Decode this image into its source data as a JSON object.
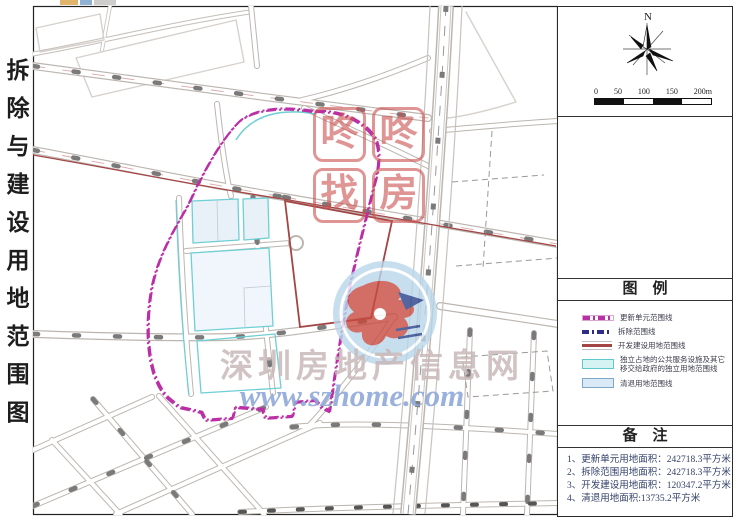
{
  "title": "拆除与建设用地范围图",
  "north": {
    "label": "N"
  },
  "scale": {
    "labels": [
      "0",
      "50",
      "100",
      "150",
      "200m"
    ]
  },
  "legend": {
    "title": "图　例",
    "items": [
      {
        "label": "更新单元范围线",
        "color": "#BB2FA6",
        "style": "dash-dot"
      },
      {
        "label": "拆除范围线",
        "color": "#2E2E88",
        "style": "dashed"
      },
      {
        "label": "开发建设用地范围线",
        "color": "#A34545",
        "style": "solid"
      },
      {
        "label": "独立占地的公共服务设施及其它",
        "label2": "移交给政府的独立用地范围线",
        "color": "#6ECFD4",
        "style": "fill"
      },
      {
        "label": "清退用地范围线",
        "color": "#9FC4DC",
        "style": "fill"
      }
    ]
  },
  "notes": {
    "title": "备　注",
    "items": [
      "1、更新单元用地面积：242718.3平方米",
      "2、拆除范围用地面积：242718.3平方米",
      "3、开发建设用地面积：120347.2平方米",
      "4、清退用地面积:13735.2平方米"
    ]
  },
  "watermarks": {
    "stamp": {
      "chars": [
        "咚",
        "咚",
        "找",
        "房"
      ],
      "color": "#CD5050"
    },
    "site_name": "深圳房地产信息网",
    "site_url": "www.szhome.com"
  },
  "colors": {
    "boundary_update_unit": "#BB2FA6",
    "boundary_demolition": "#2E2E88",
    "boundary_development": "#A34545",
    "public_facility": "#6ECFD4",
    "clear_land": "#9FC4DC",
    "street_casing": "#BCB6B0",
    "stamp_red": "#CD5050",
    "logo_blue": "#8FA9D9"
  }
}
